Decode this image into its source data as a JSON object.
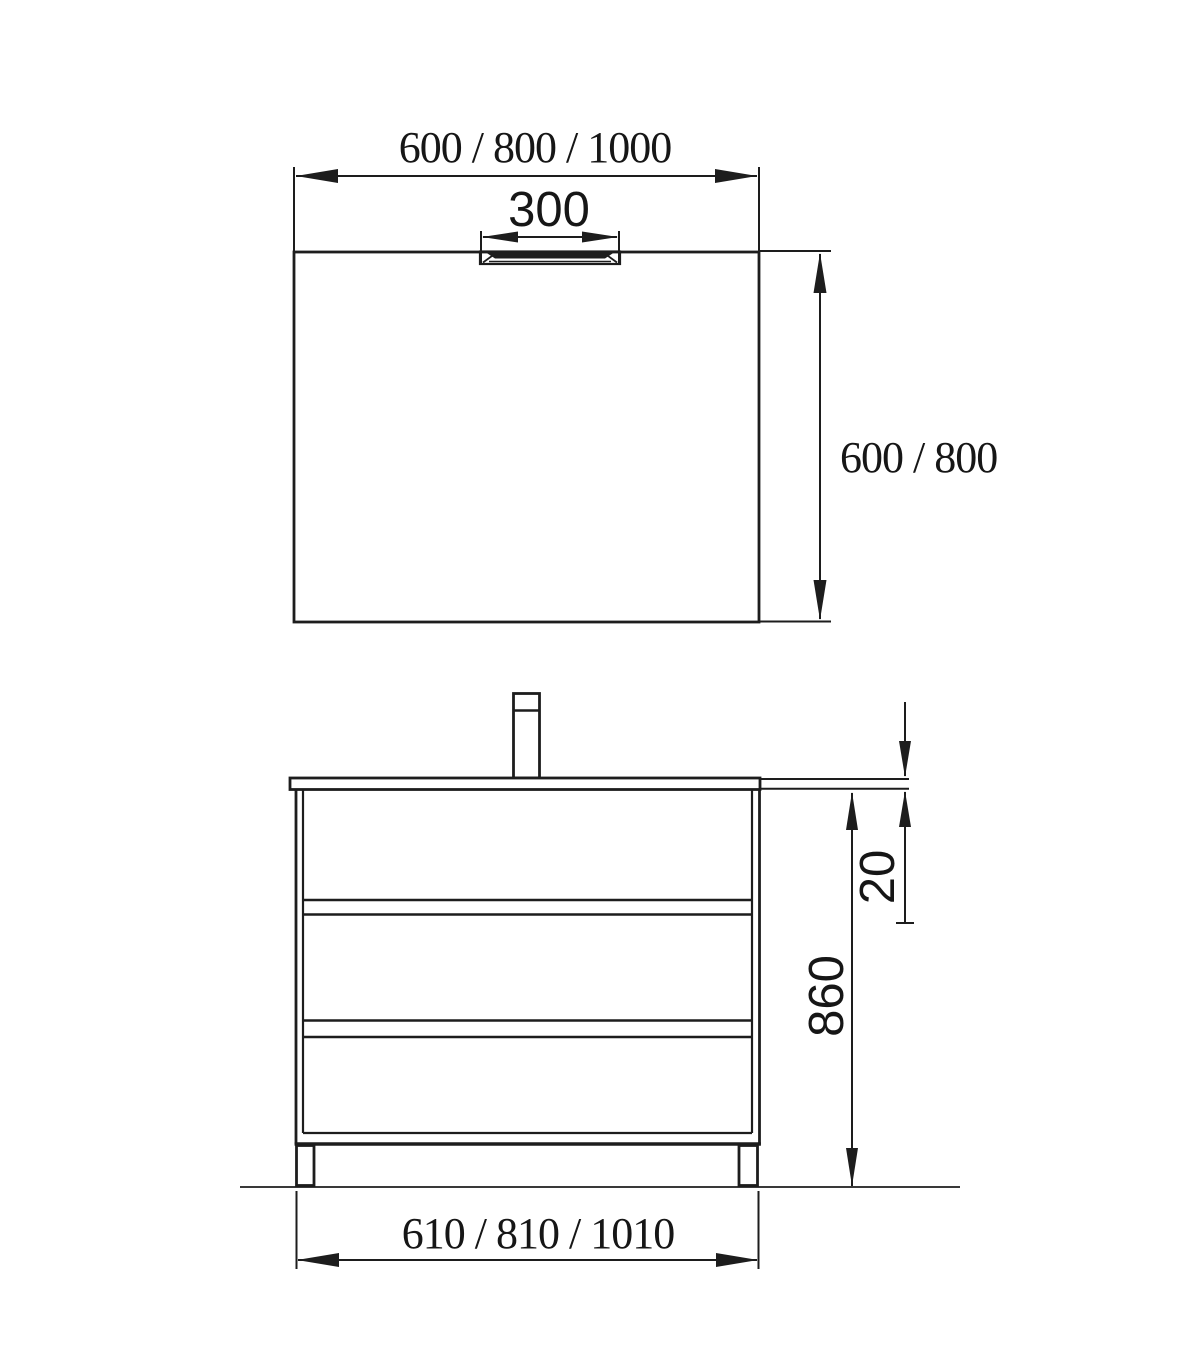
{
  "drawing": {
    "background_color": "#ffffff",
    "line_color": "#1d1d1d",
    "text_color": "#161616",
    "mirror": {
      "width_label": "600 / 800 / 1000",
      "light_width_label": "300",
      "height_label": "600 / 800"
    },
    "vanity": {
      "countertop_thickness_label": "20",
      "height_label": "860",
      "width_label": "610 / 810 / 1010"
    }
  }
}
